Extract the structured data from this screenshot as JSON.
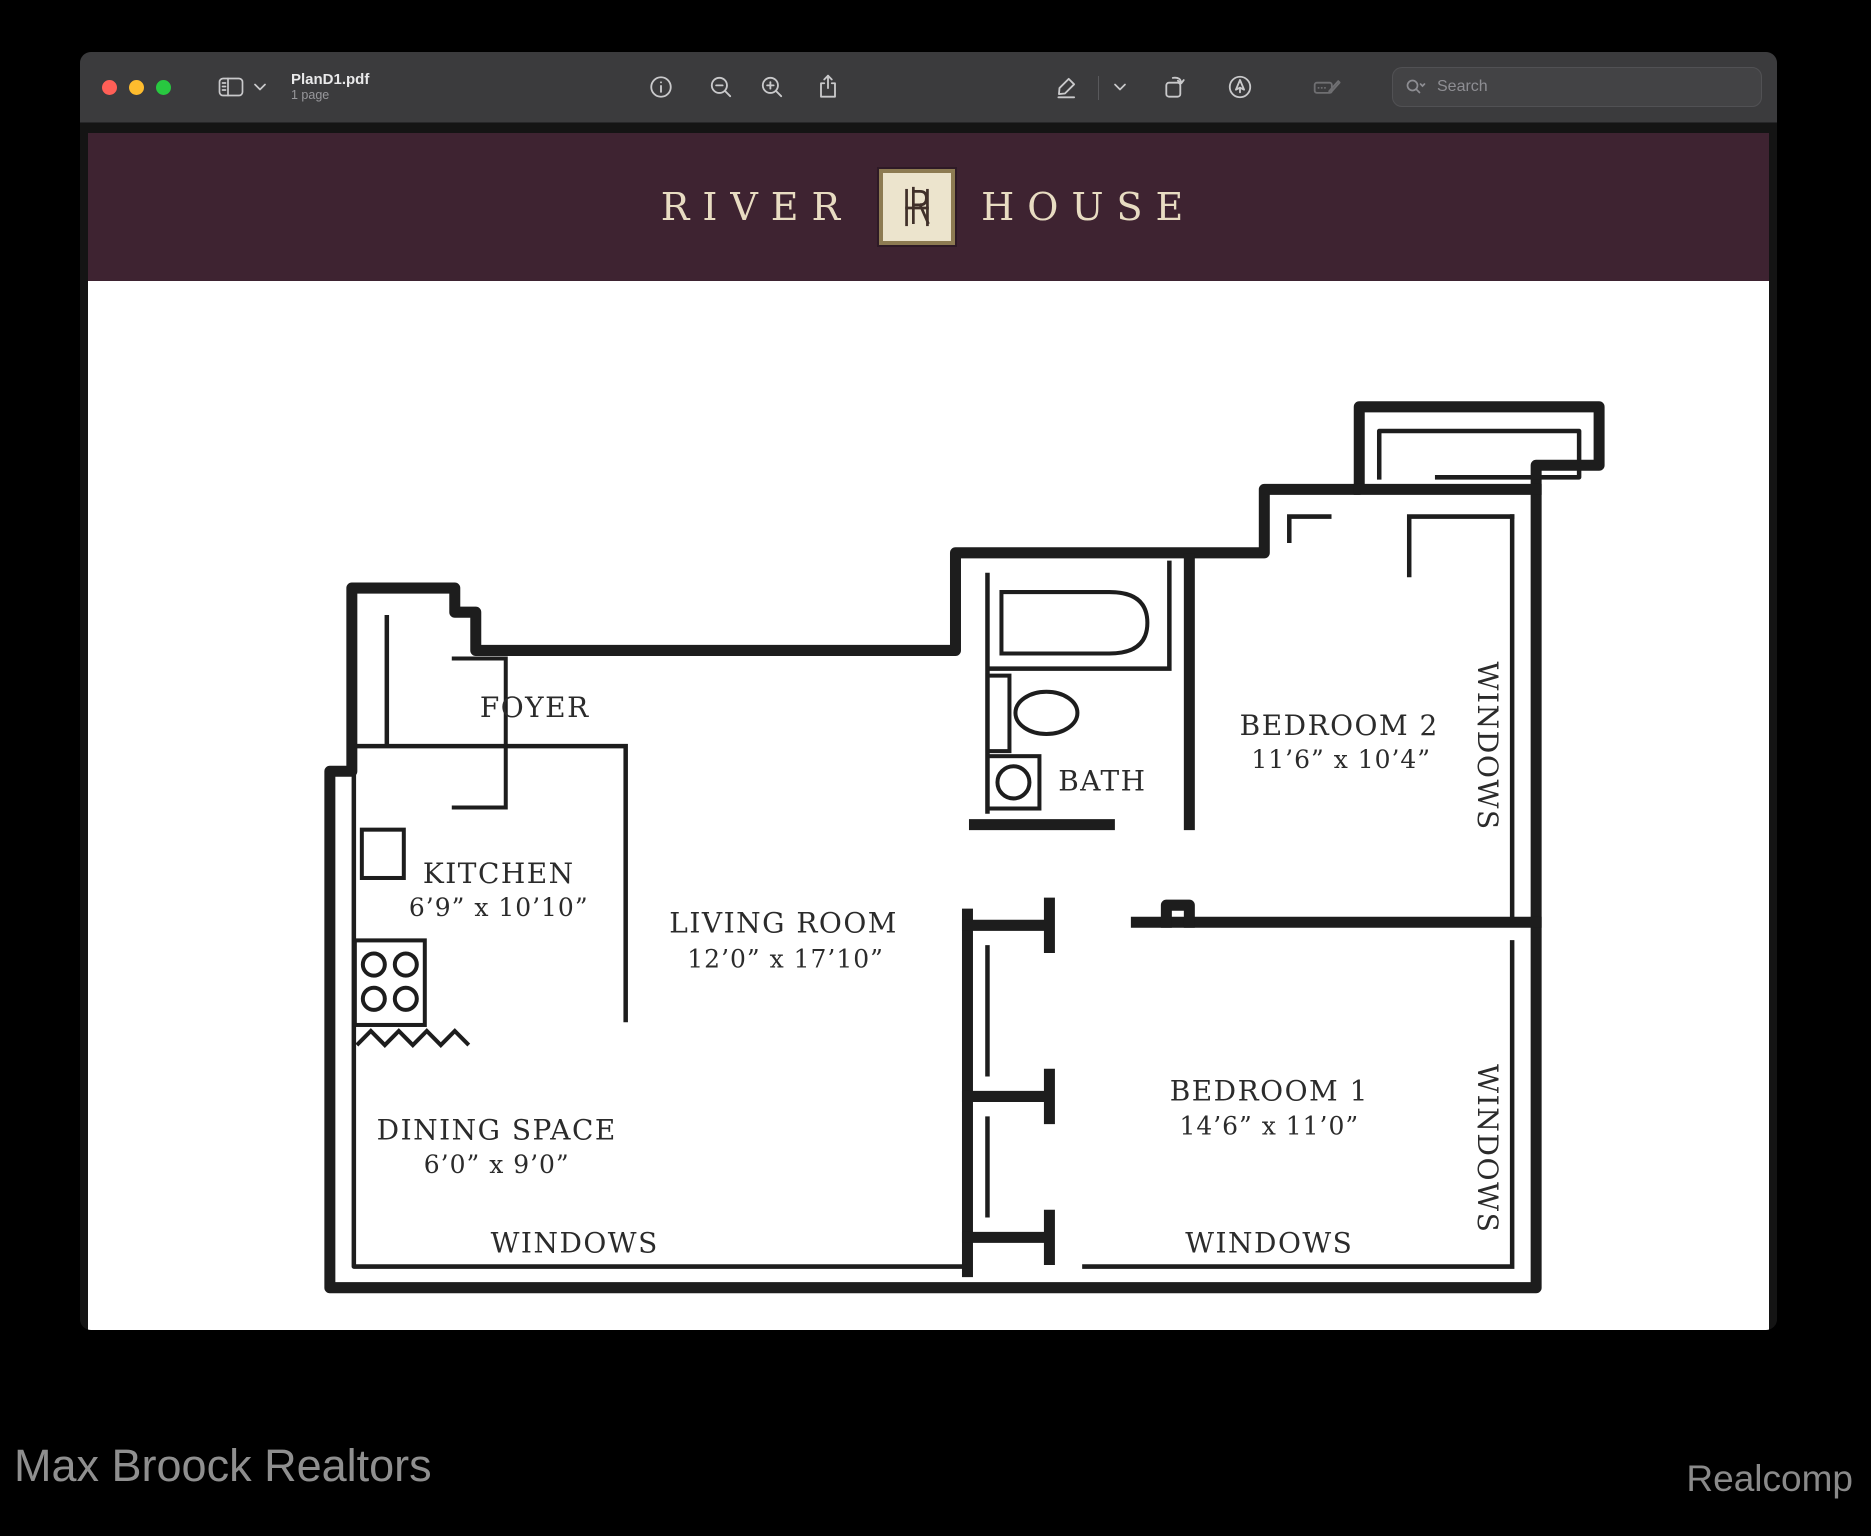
{
  "window": {
    "title": "PlanD1.pdf",
    "page_count": "1 page",
    "traffic_lights": [
      "close",
      "minimize",
      "fullscreen"
    ],
    "toolbar": {
      "icons": [
        "sidebar",
        "chevron-down",
        "info",
        "zoom-out",
        "zoom-in",
        "share",
        "markup-pen",
        "markup-chevron",
        "rotate-left",
        "annotate-pen",
        "form-fill"
      ],
      "search_placeholder": "Search"
    }
  },
  "document": {
    "banner": {
      "brand_left": "RIVER",
      "brand_right": "HOUSE",
      "monogram": "RH",
      "bg_color": "#3e2331",
      "text_color": "#e8dcc2",
      "logo_bg": "#ece4cd",
      "logo_border": "#8d7b52"
    },
    "plan": {
      "rooms": {
        "foyer": {
          "name": "FOYER"
        },
        "kitchen": {
          "name": "KITCHEN",
          "dims": "6’9” x 10’10”"
        },
        "living": {
          "name": "LIVING ROOM",
          "dims": "12’0” x 17’10”"
        },
        "dining": {
          "name": "DINING SPACE",
          "dims": "6’0” x 9’0”"
        },
        "bath": {
          "name": "BATH"
        },
        "bedroom2": {
          "name": "BEDROOM 2",
          "dims": "11’6” x 10’4”"
        },
        "bedroom1": {
          "name": "BEDROOM 1",
          "dims": "14’6” x 11’0”"
        }
      },
      "window_labels": {
        "bottom_left": "WINDOWS",
        "bottom_right": "WINDOWS",
        "right_top": "WINDOWS",
        "right_bottom": "WINDOWS"
      }
    }
  },
  "footer": {
    "left": "Max Broock Realtors",
    "right": "Realcomp"
  }
}
